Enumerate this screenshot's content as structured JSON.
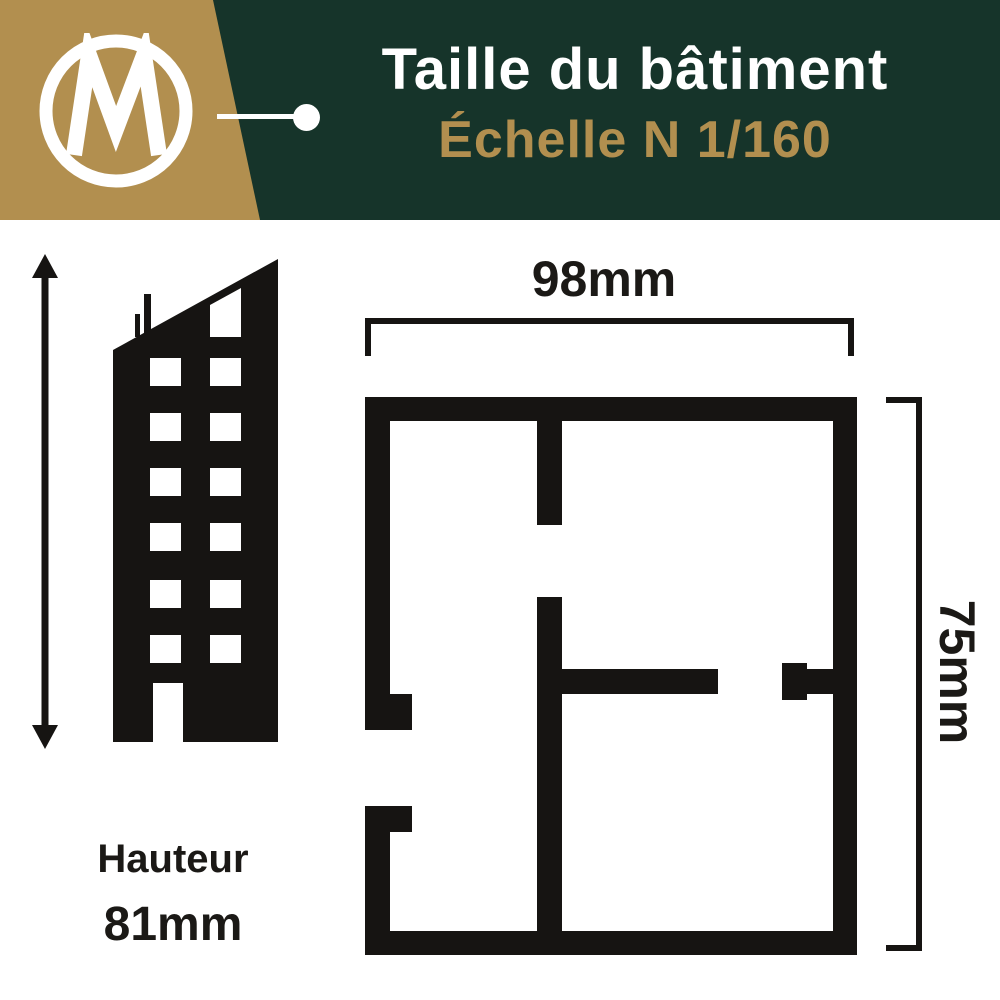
{
  "header": {
    "title": "Taille du bâtiment",
    "subtitle": "Échelle N 1/160",
    "logo_letter": "M"
  },
  "left_figure": {
    "label": "Hauteur",
    "value": "81mm"
  },
  "plan": {
    "width_value": "98mm",
    "height_value": "75mm"
  },
  "colors": {
    "header_green": "#16342a",
    "brand_gold": "#b28f4f",
    "ink": "#161412",
    "white": "#ffffff"
  },
  "icons": {
    "logo": "m-logo-icon",
    "building": "building-silhouette-icon",
    "height_arrow": "height-arrow-icon",
    "floor_plan": "floor-plan-icon"
  }
}
